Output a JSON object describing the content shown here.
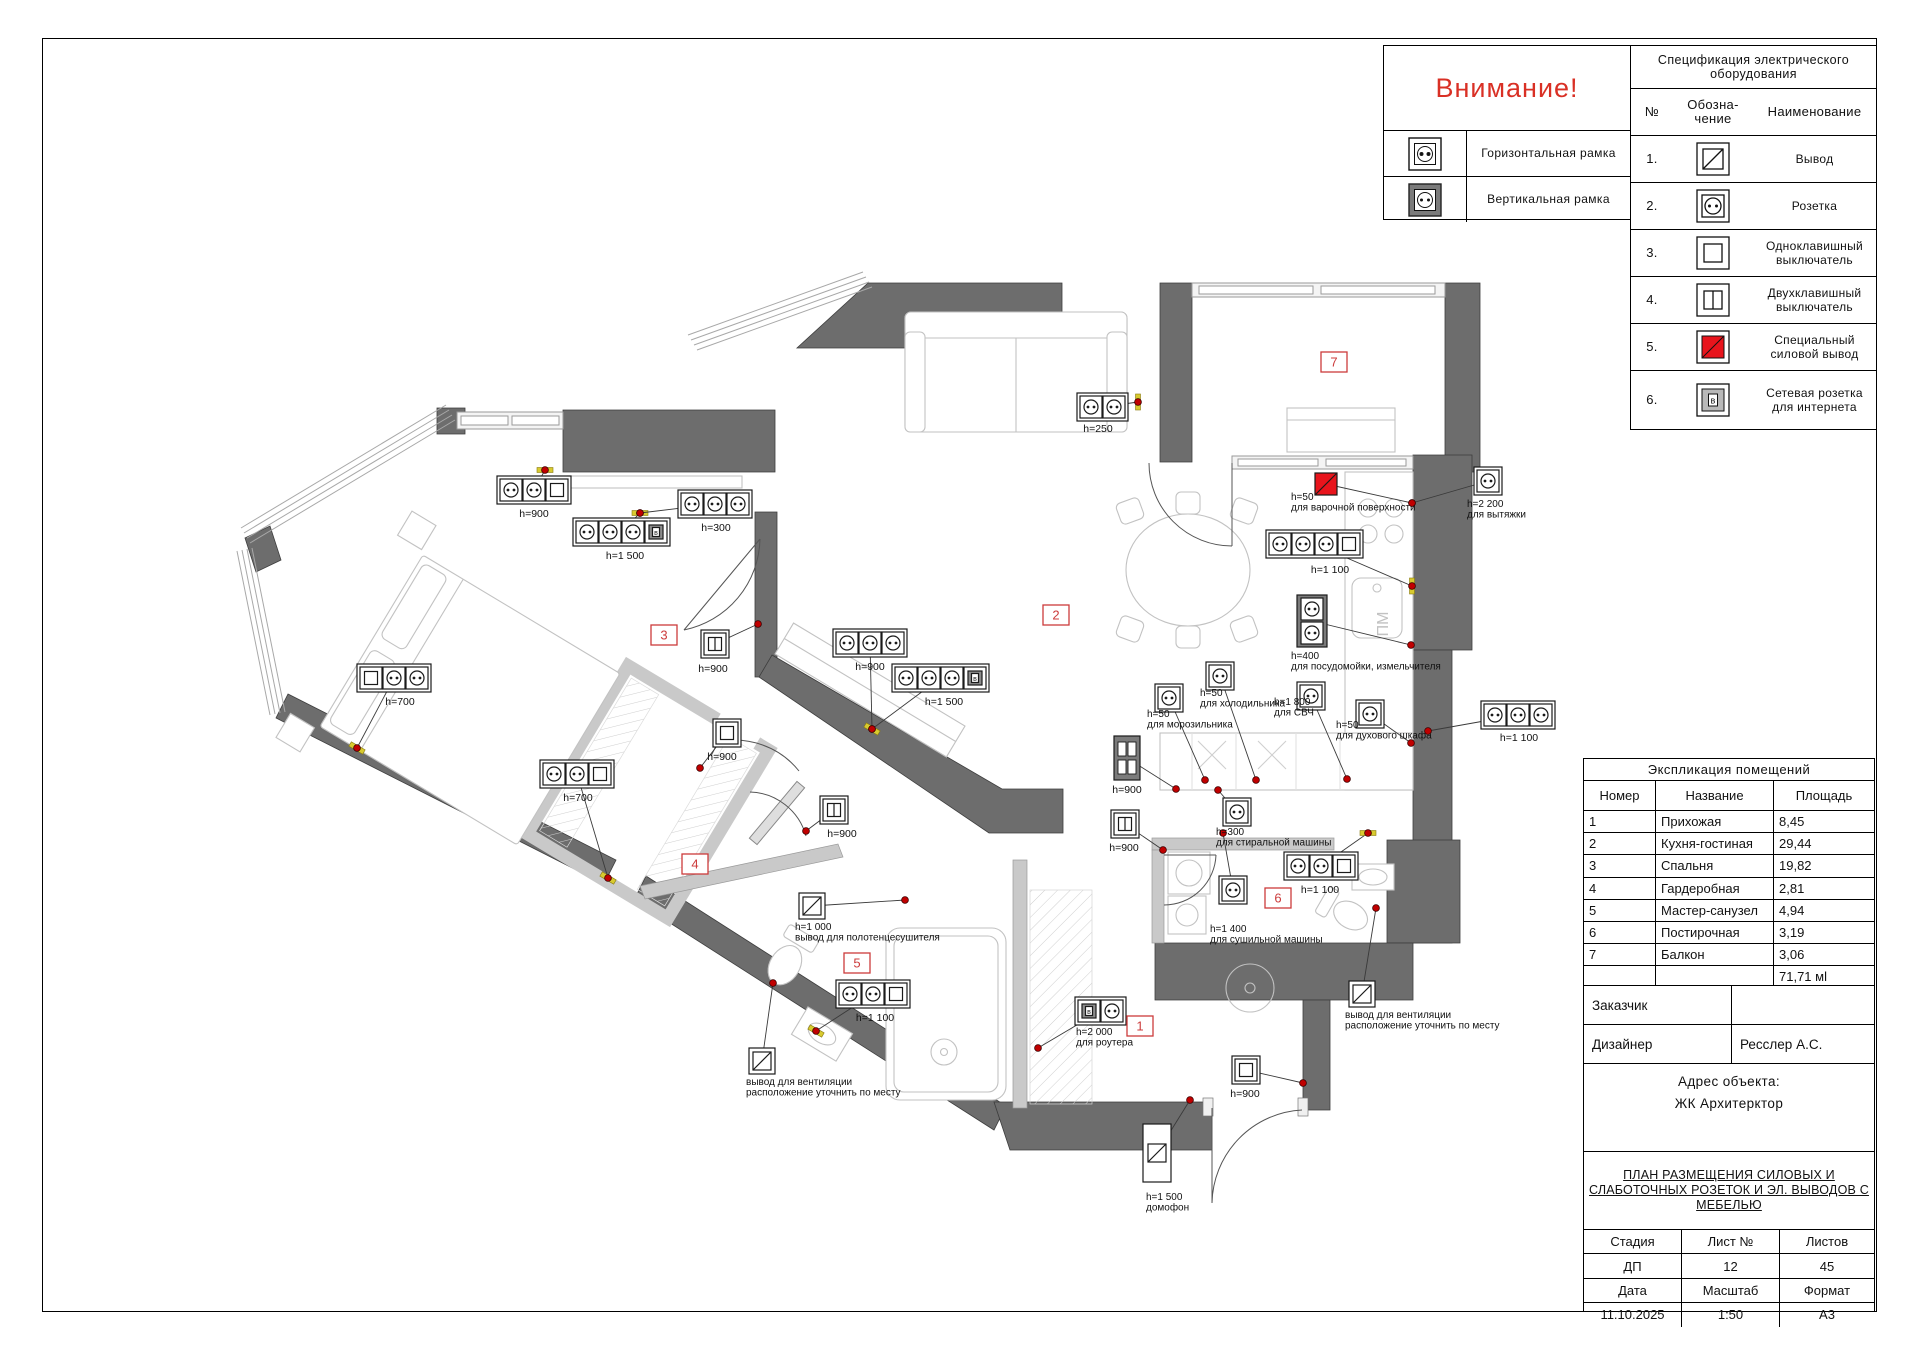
{
  "attention": {
    "title": "Внимание!",
    "rows": [
      {
        "icon": "horizontal-frame-socket-icon",
        "label": "Горизонтальная рамка"
      },
      {
        "icon": "vertical-frame-socket-icon",
        "label": "Вертикальная рамка"
      }
    ]
  },
  "spec_table": {
    "title": "Спецификация электрического оборудования",
    "headers": {
      "num": "№",
      "symbol1": "Обозна-",
      "symbol2": "чение",
      "name": "Наименование"
    },
    "rows": [
      {
        "num": "1.",
        "icon": "out-icon",
        "name": "Вывод"
      },
      {
        "num": "2.",
        "icon": "socket-icon",
        "name": "Розетка"
      },
      {
        "num": "3.",
        "icon": "switch-single-icon",
        "name": "Одноклавишный выключатель"
      },
      {
        "num": "4.",
        "icon": "switch-double-icon",
        "name": "Двухклавишный выключатель"
      },
      {
        "num": "5.",
        "icon": "special-power-icon",
        "name": "Специальный силовой вывод"
      },
      {
        "num": "6.",
        "icon": "network-socket-icon",
        "name": "Сетевая розетка для интернета"
      }
    ]
  },
  "explication": {
    "title": "Экспликация помещений",
    "headers": [
      "Номер",
      "Название",
      "Площадь"
    ],
    "rows": [
      {
        "num": "1",
        "name": "Прихожая",
        "area": "8,45"
      },
      {
        "num": "2",
        "name": "Кухня-гостиная",
        "area": "29,44"
      },
      {
        "num": "3",
        "name": "Спальня",
        "area": "19,82"
      },
      {
        "num": "4",
        "name": "Гардеробная",
        "area": "2,81"
      },
      {
        "num": "5",
        "name": "Мастер-санузел",
        "area": "4,94"
      },
      {
        "num": "6",
        "name": "Постирочная",
        "area": "3,19"
      },
      {
        "num": "7",
        "name": "Балкон",
        "area": "3,06"
      },
      {
        "num": "",
        "name": "",
        "area": "71,71 мl"
      }
    ]
  },
  "title_block": {
    "customer_label": "Заказчик",
    "customer_value": "",
    "designer_label": "Дизайнер",
    "designer_value": "Ресслер А.С.",
    "address_label": "Адрес объекта:",
    "address_value": "ЖК Архитерктор",
    "doc_title": [
      "ПЛАН РАЗМЕЩЕНИЯ СИЛОВЫХ И",
      "СЛАБОТОЧНЫХ РОЗЕТОК И ЭЛ. ВЫВОДОВ С",
      "МЕБЕЛЬЮ"
    ],
    "grid": {
      "r1": [
        "Стадия",
        "Лист №",
        "Листов"
      ],
      "r2": [
        "ДП",
        "12",
        "45"
      ],
      "r3": [
        "Дата",
        "Масштаб",
        "Формат"
      ],
      "r4": [
        "11.10.2025",
        "1:50",
        "А3"
      ]
    }
  },
  "icons": {
    "net_letter": "в"
  },
  "plan": {
    "colors": {
      "wall": "#6d6d6d",
      "partition": "#c9c9c9",
      "badge_red": "#cc3b3b",
      "special_red": "#e8141c",
      "marker_red": "#c00000",
      "marker_yellow": "#d8ca2f"
    },
    "texts": [
      {
        "t": "ПМ",
        "x": 1388,
        "y": 624,
        "r": -90,
        "s": 16,
        "c": "#c2c2c2"
      }
    ],
    "badges": [
      {
        "n": "1",
        "x": 1140,
        "y": 1026
      },
      {
        "n": "2",
        "x": 1056,
        "y": 615
      },
      {
        "n": "3",
        "x": 664,
        "y": 635
      },
      {
        "n": "4",
        "x": 695,
        "y": 864
      },
      {
        "n": "5",
        "x": 857,
        "y": 963
      },
      {
        "n": "6",
        "x": 1278,
        "y": 898
      },
      {
        "n": "7",
        "x": 1334,
        "y": 362
      }
    ],
    "devices": [
      {
        "id": "bedroom-sockets-900",
        "kind": "strip",
        "gangs": [
          "socket",
          "socket",
          "switch1"
        ],
        "x": 497,
        "y": 476,
        "label": "h=900",
        "lx": 534,
        "ly": 517,
        "dot": [
          545,
          470
        ],
        "tick": 0
      },
      {
        "id": "bedroom-sockets-1500",
        "kind": "strip",
        "gangs": [
          "socket",
          "socket",
          "socket",
          "net"
        ],
        "x": 573,
        "y": 518,
        "label": "h=1 500",
        "lx": 625,
        "ly": 559,
        "dot": [
          640,
          513
        ],
        "tick": 0
      },
      {
        "id": "bedroom-sockets-300",
        "kind": "strip",
        "gangs": [
          "socket",
          "socket",
          "socket"
        ],
        "x": 678,
        "y": 490,
        "label": "h=300",
        "lx": 716,
        "ly": 531,
        "dot": [
          640,
          513
        ]
      },
      {
        "id": "bedroom-sockets-700-left",
        "kind": "strip",
        "gangs": [
          "switch1",
          "socket",
          "socket"
        ],
        "x": 357,
        "y": 664,
        "label": "h=700",
        "lx": 400,
        "ly": 705,
        "dot": [
          357,
          748
        ],
        "tick": 30
      },
      {
        "id": "bedroom-sockets-700-right",
        "kind": "strip",
        "gangs": [
          "socket",
          "socket",
          "switch1"
        ],
        "x": 540,
        "y": 760,
        "label": "h=700",
        "lx": 578,
        "ly": 801,
        "dot": [
          608,
          878
        ],
        "tick": 30
      },
      {
        "id": "bedroom-door-switch-900",
        "kind": "single",
        "gang": "switch2",
        "x": 701,
        "y": 630,
        "label": "h=900",
        "lx": 713,
        "ly": 672,
        "dot": [
          758,
          624
        ]
      },
      {
        "id": "hall-sockets-900",
        "kind": "strip",
        "gangs": [
          "socket",
          "socket",
          "socket"
        ],
        "x": 833,
        "y": 629,
        "label": "h=900",
        "lx": 870,
        "ly": 670,
        "dot": [
          872,
          729
        ],
        "tick": 30
      },
      {
        "id": "hall-sockets-1500",
        "kind": "strip",
        "gangs": [
          "socket",
          "socket",
          "socket",
          "net"
        ],
        "x": 892,
        "y": 664,
        "label": "h=1 500",
        "lx": 944,
        "ly": 705,
        "dot": [
          872,
          729
        ]
      },
      {
        "id": "wardrobe-switch-900",
        "kind": "single",
        "gang": "switch1",
        "x": 713,
        "y": 719,
        "label": "h=900",
        "lx": 722,
        "ly": 760,
        "dot": [
          700,
          768
        ]
      },
      {
        "id": "hall-switch-900",
        "kind": "single",
        "gang": "switch2",
        "x": 820,
        "y": 796,
        "label": "h=900",
        "lx": 842,
        "ly": 837,
        "dot": [
          806,
          831
        ]
      },
      {
        "id": "router-sockets-2000",
        "kind": "strip",
        "gangs": [
          "net",
          "socket"
        ],
        "x": 1075,
        "y": 997,
        "lines": [
          "h=2 000",
          "для роутера"
        ],
        "lx": 1076,
        "ly": 1035,
        "dot": [
          1038,
          1048
        ]
      },
      {
        "id": "entry-switch-900",
        "kind": "single",
        "gang": "switch1",
        "x": 1232,
        "y": 1056,
        "label": "h=900",
        "lx": 1245,
        "ly": 1097,
        "dot": [
          1303,
          1083
        ]
      },
      {
        "id": "intercom-1500",
        "kind": "domofon",
        "x": 1143,
        "y": 1124,
        "lines": [
          "h=1 500",
          "домофон"
        ],
        "lx": 1146,
        "ly": 1200,
        "dot": [
          1190,
          1100
        ]
      },
      {
        "id": "towel-dryer-out-1000",
        "kind": "out",
        "x": 799,
        "y": 893,
        "lines": [
          "h=1 000",
          "вывод для полотенцесушителя"
        ],
        "lx": 795,
        "ly": 930,
        "dot": [
          905,
          900
        ]
      },
      {
        "id": "masterbath-sockets-1100",
        "kind": "strip",
        "gangs": [
          "socket",
          "socket",
          "switch1"
        ],
        "x": 836,
        "y": 980,
        "label": "h=1 100",
        "lx": 875,
        "ly": 1021,
        "dot": [
          816,
          1031
        ],
        "tick": 30
      },
      {
        "id": "masterbath-vent-out",
        "kind": "out",
        "x": 749,
        "y": 1048,
        "lines": [
          "вывод для вентиляции",
          "расположение уточнить по месту"
        ],
        "lx": 746,
        "ly": 1085,
        "dot": [
          773,
          983
        ]
      },
      {
        "id": "hob-power-50",
        "kind": "special",
        "x": 1315,
        "y": 473,
        "lines": [
          "h=50",
          "для варочной поверхности"
        ],
        "lx": 1291,
        "ly": 500,
        "dot": [
          1412,
          503
        ]
      },
      {
        "id": "hood-socket-2200",
        "kind": "single",
        "gang": "socket",
        "x": 1474,
        "y": 467,
        "lines": [
          "h=2 200",
          "для вытяжки"
        ],
        "lx": 1467,
        "ly": 507,
        "dot": [
          1412,
          503
        ]
      },
      {
        "id": "kitchen-sockets-1100",
        "kind": "strip",
        "gangs": [
          "socket",
          "socket",
          "socket",
          "switch1"
        ],
        "x": 1266,
        "y": 530,
        "label": "h=1 100",
        "lx": 1330,
        "ly": 573,
        "dot": [
          1412,
          586
        ],
        "tick": 90
      },
      {
        "id": "dishwasher-sockets-400",
        "kind": "vsocket2",
        "x": 1297,
        "y": 595,
        "lines": [
          "h=400",
          "для посудомойки, измельчителя"
        ],
        "lx": 1291,
        "ly": 659,
        "dot": [
          1411,
          645
        ]
      },
      {
        "id": "freezer-socket-50",
        "kind": "single",
        "gang": "socket",
        "x": 1155,
        "y": 684,
        "lines": [
          "h=50",
          "для морозильника"
        ],
        "lx": 1147,
        "ly": 717,
        "dot": [
          1205,
          780
        ]
      },
      {
        "id": "fridge-socket-50",
        "kind": "single",
        "gang": "socket",
        "x": 1206,
        "y": 662,
        "lines": [
          "h=50",
          "для холодильника"
        ],
        "lx": 1200,
        "ly": 696,
        "dot": [
          1256,
          780
        ]
      },
      {
        "id": "microwave-socket-1800",
        "kind": "single",
        "gang": "socket",
        "x": 1297,
        "y": 682,
        "lines": [
          "h=1 800",
          "для СВЧ"
        ],
        "lx": 1274,
        "ly": 705,
        "dot": [
          1347,
          779
        ]
      },
      {
        "id": "oven-socket-50",
        "kind": "single",
        "gang": "socket",
        "x": 1356,
        "y": 700,
        "lines": [
          "h=50",
          "для духового шкафа"
        ],
        "lx": 1336,
        "ly": 728,
        "dot": [
          1411,
          743
        ]
      },
      {
        "id": "right-sockets-1100",
        "kind": "strip",
        "gangs": [
          "socket",
          "socket",
          "socket"
        ],
        "x": 1481,
        "y": 701,
        "label": "h=1 100",
        "lx": 1519,
        "ly": 741,
        "dot": [
          1428,
          731
        ]
      },
      {
        "id": "sofa-sockets-250",
        "kind": "strip",
        "gangs": [
          "socket",
          "socket"
        ],
        "x": 1077,
        "y": 393,
        "label": "h=250",
        "lx": 1098,
        "ly": 432,
        "dot": [
          1138,
          402
        ],
        "tick": 90
      },
      {
        "id": "kitchen-vswitch-900",
        "kind": "vswitch2",
        "x": 1114,
        "y": 736,
        "label": "h=900",
        "lx": 1127,
        "ly": 793,
        "dot": [
          1176,
          789
        ]
      },
      {
        "id": "kitchen-switch-900",
        "kind": "single",
        "gang": "switch2",
        "x": 1111,
        "y": 810,
        "label": "h=900",
        "lx": 1124,
        "ly": 851,
        "dot": [
          1163,
          850
        ]
      },
      {
        "id": "dryer-socket-1400",
        "kind": "single",
        "gang": "socket",
        "x": 1219,
        "y": 876,
        "lines": [
          "h=1 400",
          "для сушильной машины"
        ],
        "lx": 1210,
        "ly": 932,
        "dot": [
          1223,
          833
        ]
      },
      {
        "id": "laundry-sockets-1100",
        "kind": "strip",
        "gangs": [
          "socket",
          "socket",
          "switch1"
        ],
        "x": 1284,
        "y": 852,
        "label": "h=1 100",
        "lx": 1320,
        "ly": 893,
        "dot": [
          1368,
          833
        ],
        "tick": 0
      },
      {
        "id": "washer-socket-300",
        "kind": "single",
        "gang": "socket",
        "x": 1223,
        "y": 798,
        "lines": [
          "h=300",
          "для стиральной машины"
        ],
        "lx": 1216,
        "ly": 835,
        "dot": [
          1218,
          790
        ]
      },
      {
        "id": "laundry-vent-out",
        "kind": "out",
        "x": 1349,
        "y": 981,
        "lines": [
          "вывод для вентиляции",
          "расположение уточнить по месту"
        ],
        "lx": 1345,
        "ly": 1018,
        "dot": [
          1376,
          908
        ]
      }
    ]
  }
}
